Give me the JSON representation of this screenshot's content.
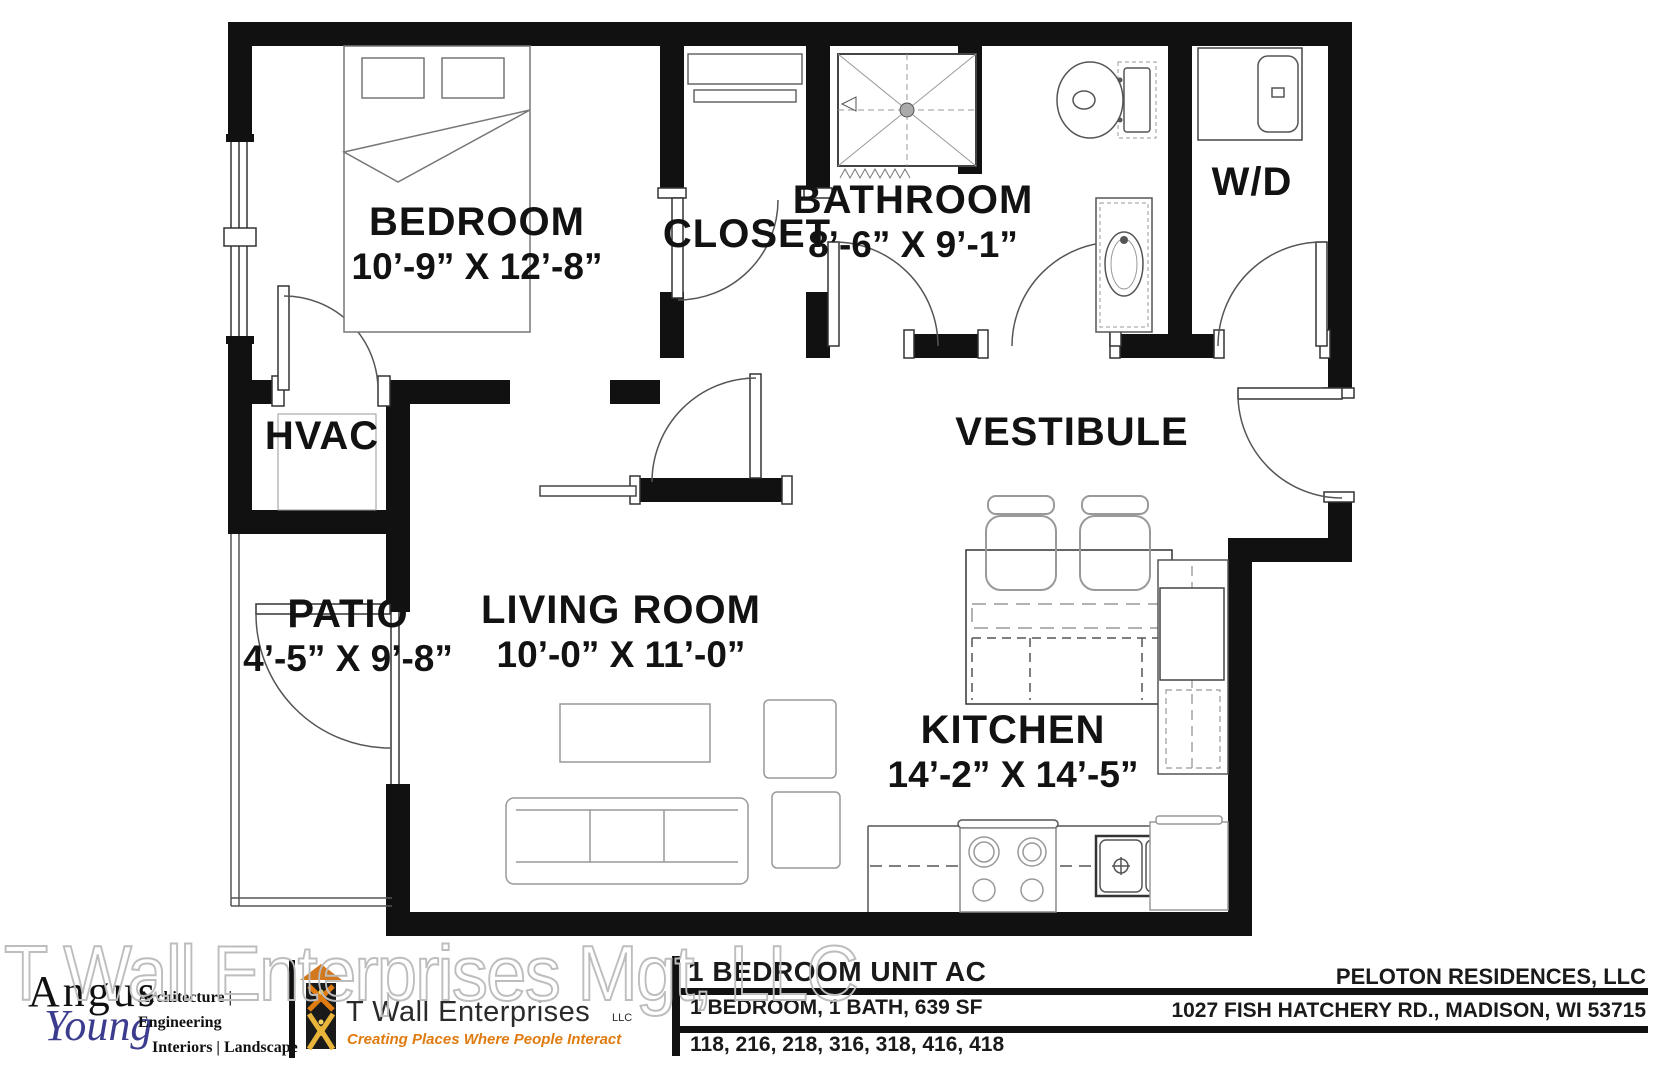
{
  "watermark": "T Wall Enterprises Mgt, LLC",
  "rooms": {
    "bedroom": {
      "name": "BEDROOM",
      "dims": "10’-9” X 12’-8”"
    },
    "closet": {
      "name": "CLOSET"
    },
    "bathroom": {
      "name": "BATHROOM",
      "dims": "8’-6” X 9’-1”"
    },
    "washer_dryer": {
      "name": "W/D"
    },
    "hvac": {
      "name": "HVAC"
    },
    "vestibule": {
      "name": "VESTIBULE"
    },
    "patio": {
      "name": "PATIO",
      "dims": "4’-5” X 9’-8”"
    },
    "living_room": {
      "name": "LIVING ROOM",
      "dims": "10’-0” X 11’-0”"
    },
    "kitchen": {
      "name": "KITCHEN",
      "dims": "14’-2” X 14’-5”"
    }
  },
  "title_block": {
    "unit_title": "1 BEDROOM UNIT AC",
    "unit_specs": "1 BEDROOM, 1 BATH, 639 SF",
    "unit_numbers": "118, 216, 218, 316, 318, 416, 418",
    "owner": "PELOTON RESIDENCES, LLC",
    "address": "1027 FISH HATCHERY RD., MADISON, WI 53715",
    "architect": {
      "name_line1": "Angus",
      "name_line2": "Young",
      "services_line1": "Architecture | Engineering",
      "services_line2": "Interiors | Landscape"
    },
    "developer": {
      "name": "T Wall Enterprises",
      "suffix": "LLC",
      "tagline": "Creating Places Where People Interact"
    }
  },
  "colors": {
    "wall_black": "#111111",
    "accent_orange": "#e07b10",
    "logo_gold": "#e8b53a",
    "logo_blue": "#3c3c8e",
    "watermark_gray": "#bdbdbd"
  }
}
